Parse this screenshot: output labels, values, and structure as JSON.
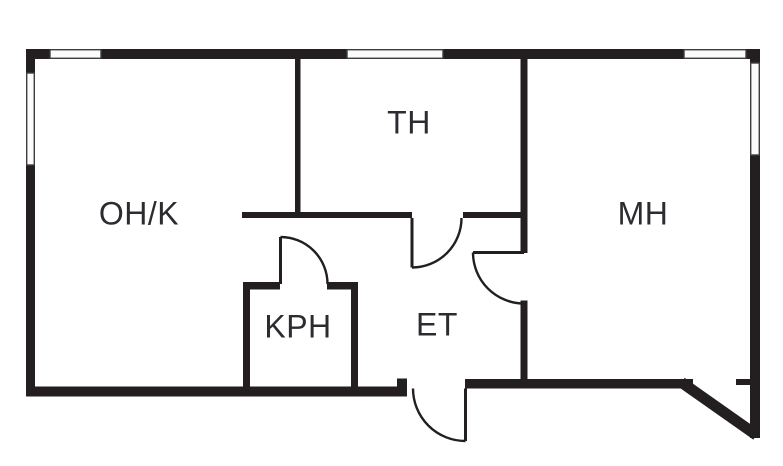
{
  "plan": {
    "type": "apartment floor plan",
    "rooms": [
      {
        "id": "ohk",
        "label": "OH/K"
      },
      {
        "id": "th",
        "label": "TH"
      },
      {
        "id": "mh",
        "label": "MH"
      },
      {
        "id": "kph",
        "label": "KPH"
      },
      {
        "id": "et",
        "label": "ET"
      }
    ],
    "features": {
      "windows": 5,
      "door_swings": 4,
      "diagonal_wall_bottom_right": true
    },
    "colors": {
      "wall": "#231f20",
      "label_text": "#2c2b30",
      "background": "#ffffff",
      "window_fill": "#fbfbfb",
      "window_outline": "#3d3d3d"
    }
  }
}
